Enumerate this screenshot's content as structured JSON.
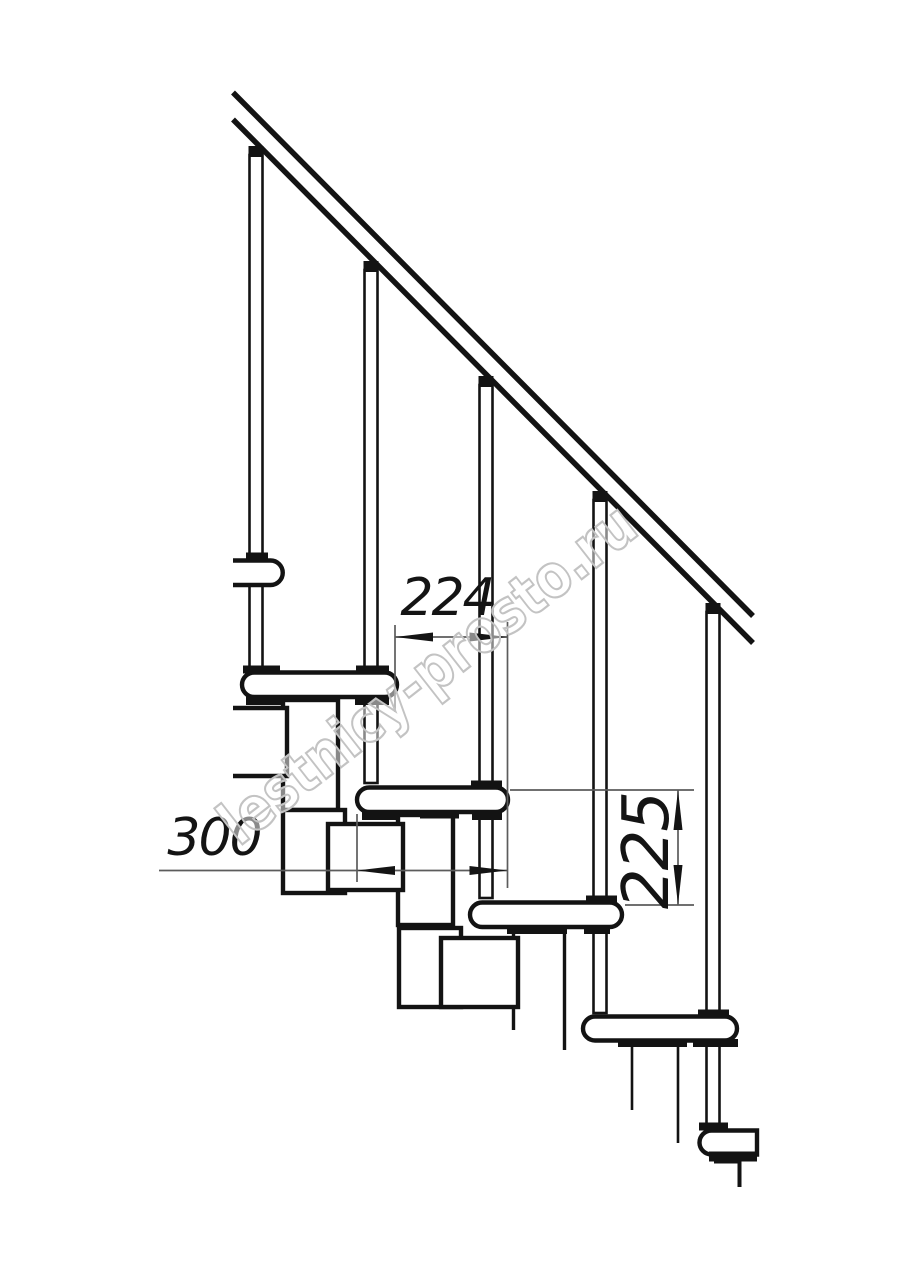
{
  "drawing": {
    "kind": "modular-staircase-side-elevation"
  },
  "dimensions": {
    "going": "224",
    "tread_depth": "300",
    "rise": "225"
  },
  "watermark": {
    "text": "lestnicy-prosto.ru"
  },
  "colors": {
    "line": "#131313",
    "fill_white": "#ffffff",
    "dim_line": "#5c5c5c",
    "dim_text": "#141414",
    "watermark": "#c3c3c3",
    "background": "#ffffff"
  }
}
